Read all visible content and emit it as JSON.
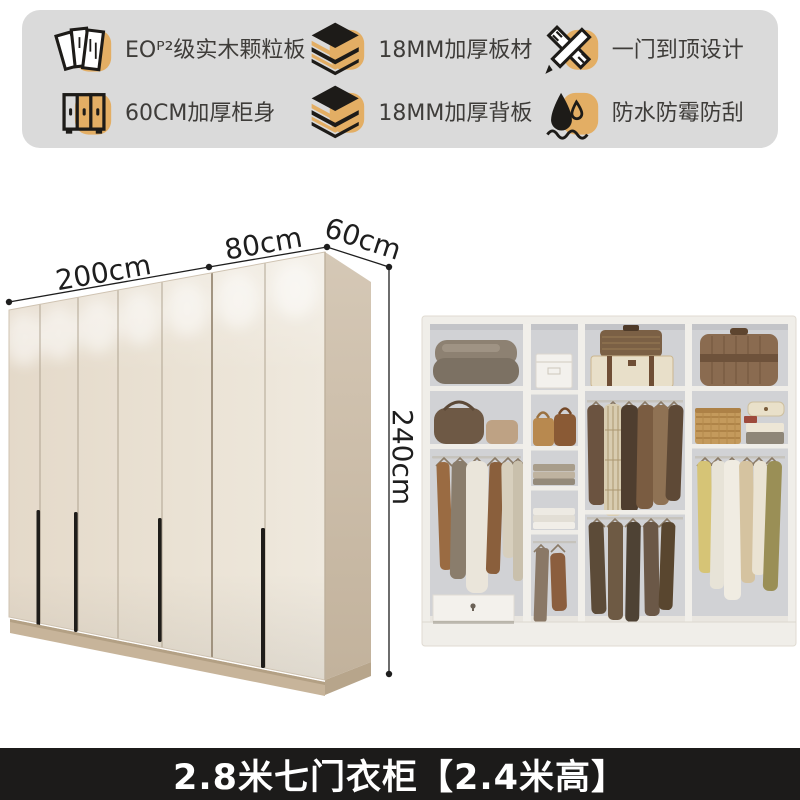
{
  "features": {
    "items": [
      {
        "icon": "particle-board-icon",
        "label": "EOᴾ²级实木颗粒板"
      },
      {
        "icon": "thick-panel-icon",
        "label": "18MM加厚板材"
      },
      {
        "icon": "full-door-design-icon",
        "label": "一门到顶设计"
      },
      {
        "icon": "thick-cabinet-icon",
        "label": "60CM加厚柜身"
      },
      {
        "icon": "thick-back-panel-icon",
        "label": "18MM加厚背板"
      },
      {
        "icon": "waterproof-icon",
        "label": "防水防霉防刮"
      }
    ]
  },
  "wardrobe": {
    "dim_width_main": "200cm",
    "dim_width_side": "80cm",
    "dim_depth": "60cm",
    "dim_height": "240cm",
    "door_count": 7
  },
  "caption": {
    "text": "2.8米七门衣柜【2.4米高】"
  },
  "colors": {
    "accent_tan": "#E3AE64",
    "panel_gray": "#DADADA",
    "caption_bg": "#1C1B1A",
    "door_light": "#EFE9DE",
    "door_dark": "#E6DCCD",
    "side_panel": "#CBBDA9",
    "plinth": "#C7B49A",
    "interior_wall": "#D1D2D5",
    "interior_frame": "#F0EEE9"
  }
}
